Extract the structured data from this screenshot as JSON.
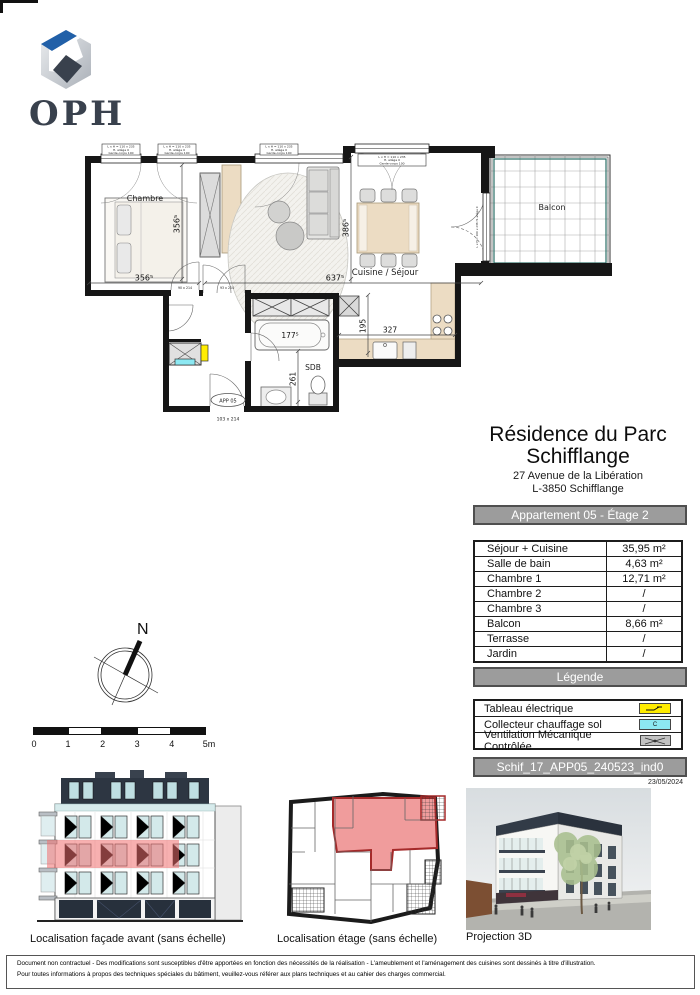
{
  "logo": {
    "text": "OPH"
  },
  "plan": {
    "rooms": {
      "chambre": "Chambre",
      "cuisine_sejour": "Cuisine / Séjour",
      "sdb": "SDB",
      "balcon": "Balcon"
    },
    "dims": {
      "chambre_w": "356⁵",
      "chambre_h": "356⁵",
      "sejour_w": "637⁵",
      "table_h": "386⁵",
      "bath": "177⁵",
      "sdb_h": "261",
      "kitchen_h": "195",
      "kitchen_w": "327"
    },
    "entry": {
      "badge": "APP 05",
      "door_size": "103 x 214"
    },
    "window_label": {
      "line1": "L x H = 110 x 235",
      "line2": "H. allège 0",
      "line3": "Garde-corps 100"
    },
    "balcony_door_label": "L x H = 200 x 236  H. allège 0",
    "door_dim_left": "90 x 214",
    "door_dim_right": "93 x 214"
  },
  "title_block": {
    "title_line1": "Résidence du Parc",
    "title_line2": "Schifflange",
    "address_line1": "27 Avenue de la Libération",
    "address_line2": "L-3850 Schifflange",
    "apartment_banner": "Appartement 05 - Étage 2"
  },
  "surface_table": {
    "rows": [
      {
        "label": "Séjour + Cuisine",
        "value": "35,95 m²"
      },
      {
        "label": "Salle de bain",
        "value": "4,63 m²"
      },
      {
        "label": "Chambre 1",
        "value": "12,71 m²"
      },
      {
        "label": "Chambre 2",
        "value": "/"
      },
      {
        "label": "Chambre 3",
        "value": "/"
      },
      {
        "label": "Balcon",
        "value": "8,66 m²"
      },
      {
        "label": "Terrasse",
        "value": "/"
      },
      {
        "label": "Jardin",
        "value": "/"
      }
    ]
  },
  "legend": {
    "banner": "Légende",
    "items": [
      {
        "label": "Tableau électrique"
      },
      {
        "label": "Collecteur chauffage sol",
        "swatch_text": "C"
      },
      {
        "label": "Ventilation Mécanique Contrôlée"
      }
    ]
  },
  "reference": {
    "code": "Schif_17_APP05_240523_ind0",
    "date": "23/05/2024"
  },
  "compass": {
    "north_label": "N"
  },
  "scale_bar": {
    "ticks": [
      "0",
      "1",
      "2",
      "3",
      "4",
      "5m"
    ]
  },
  "figures": {
    "facade_caption": "Localisation façade avant (sans échelle)",
    "etage_caption": "Localisation étage (sans échelle)",
    "projection_caption": "Projection 3D"
  },
  "footer": {
    "line1": "Document non contractuel - Des modifications sont susceptibles d'être apportées en fonction des nécessités de la réalisation - L'ameublement et l'aménagement des cuisines sont dessinés à titre d'illustration.",
    "line2": "Pour toutes informations à propos des techniques spéciales du bâtiment, veuillez-vous référer aux plans techniques et au cahier des charges commercial."
  },
  "colors": {
    "accent_yellow": "#ffec00",
    "accent_cyan": "#8ce8f2",
    "banner_gray": "#9c9c9c",
    "highlight_red": "#f07070",
    "balcony_teal": "#2a6e66",
    "logo_blue": "#2160a8",
    "logo_dark": "#39414d"
  }
}
